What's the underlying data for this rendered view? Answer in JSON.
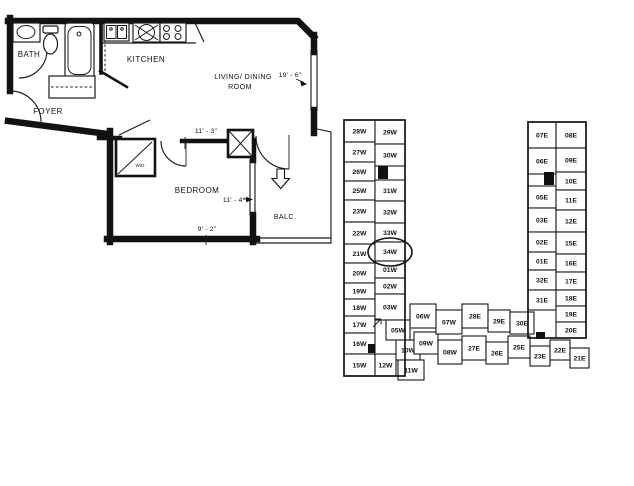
{
  "floor_plan": {
    "room_labels": {
      "bath": "BATH",
      "kitchen": "KITCHEN",
      "foyer": "FOYER",
      "living_line1": "LIVING/ DINING",
      "living_line2": "ROOM",
      "bedroom": "BEDROOM",
      "balcony": "BALC.",
      "washer_dryer": "W/D"
    },
    "dimensions": {
      "living_depth": "19' - 6\"",
      "bedroom_width_top": "11' - 3\"",
      "bedroom_depth": "11' - 4\"",
      "bedroom_width_bottom": "9' - 2\""
    }
  },
  "key_plan": {
    "highlighted_unit": "34W",
    "units": [
      {
        "label": "28W",
        "x": 2,
        "y": 12,
        "w": 31,
        "h": 22
      },
      {
        "label": "27W",
        "x": 2,
        "y": 34,
        "w": 31,
        "h": 20
      },
      {
        "label": "26W",
        "x": 2,
        "y": 54,
        "w": 31,
        "h": 19
      },
      {
        "label": "25W",
        "x": 2,
        "y": 73,
        "w": 31,
        "h": 19
      },
      {
        "label": "23W",
        "x": 2,
        "y": 92,
        "w": 31,
        "h": 22
      },
      {
        "label": "22W",
        "x": 2,
        "y": 114,
        "w": 31,
        "h": 22
      },
      {
        "label": "21W",
        "x": 2,
        "y": 136,
        "w": 31,
        "h": 19
      },
      {
        "label": "20W",
        "x": 2,
        "y": 155,
        "w": 31,
        "h": 20
      },
      {
        "label": "19W",
        "x": 2,
        "y": 175,
        "w": 31,
        "h": 16
      },
      {
        "label": "18W",
        "x": 2,
        "y": 191,
        "w": 31,
        "h": 17
      },
      {
        "label": "17W",
        "x": 2,
        "y": 208,
        "w": 31,
        "h": 17
      },
      {
        "label": "16W",
        "x": 2,
        "y": 225,
        "w": 31,
        "h": 21
      },
      {
        "label": "15W",
        "x": 2,
        "y": 246,
        "w": 31,
        "h": 22
      },
      {
        "label": "29W",
        "x": 33,
        "y": 12,
        "w": 30,
        "h": 24
      },
      {
        "label": "30W",
        "x": 33,
        "y": 36,
        "w": 30,
        "h": 22
      },
      {
        "label": "31W",
        "x": 33,
        "y": 72,
        "w": 30,
        "h": 21
      },
      {
        "label": "32W",
        "x": 33,
        "y": 93,
        "w": 30,
        "h": 22
      },
      {
        "label": "33W",
        "x": 33,
        "y": 115,
        "w": 30,
        "h": 19
      },
      {
        "label": "34W",
        "x": 33,
        "y": 134,
        "w": 30,
        "h": 19
      },
      {
        "label": "01W",
        "x": 33,
        "y": 153,
        "w": 30,
        "h": 17
      },
      {
        "label": "02W",
        "x": 33,
        "y": 170,
        "w": 30,
        "h": 16
      },
      {
        "label": "03W",
        "x": 33,
        "y": 186,
        "w": 30,
        "h": 26
      },
      {
        "label": "05W",
        "x": 44,
        "y": 212,
        "w": 24,
        "h": 20
      },
      {
        "label": "10W",
        "x": 54,
        "y": 232,
        "w": 24,
        "h": 20
      },
      {
        "label": "12W",
        "x": 33,
        "y": 246,
        "w": 21,
        "h": 22
      },
      {
        "label": "11W",
        "x": 56,
        "y": 252,
        "w": 26,
        "h": 20
      },
      {
        "label": "06W",
        "x": 68,
        "y": 196,
        "w": 26,
        "h": 24
      },
      {
        "label": "09W",
        "x": 72,
        "y": 224,
        "w": 24,
        "h": 22
      },
      {
        "label": "07W",
        "x": 94,
        "y": 202,
        "w": 26,
        "h": 24
      },
      {
        "label": "08W",
        "x": 96,
        "y": 232,
        "w": 24,
        "h": 24
      },
      {
        "label": "28E",
        "x": 120,
        "y": 196,
        "w": 26,
        "h": 24
      },
      {
        "label": "27E",
        "x": 120,
        "y": 228,
        "w": 24,
        "h": 24
      },
      {
        "label": "29E",
        "x": 146,
        "y": 202,
        "w": 22,
        "h": 22
      },
      {
        "label": "26E",
        "x": 144,
        "y": 234,
        "w": 22,
        "h": 22
      },
      {
        "label": "30E",
        "x": 168,
        "y": 204,
        "w": 24,
        "h": 22
      },
      {
        "label": "25E",
        "x": 166,
        "y": 228,
        "w": 22,
        "h": 22
      },
      {
        "label": "23E",
        "x": 188,
        "y": 238,
        "w": 20,
        "h": 20
      },
      {
        "label": "22E",
        "x": 208,
        "y": 232,
        "w": 20,
        "h": 20
      },
      {
        "label": "21E",
        "x": 228,
        "y": 240,
        "w": 19,
        "h": 20
      },
      {
        "label": "07E",
        "x": 186,
        "y": 14,
        "w": 28,
        "h": 26
      },
      {
        "label": "06E",
        "x": 186,
        "y": 40,
        "w": 28,
        "h": 26
      },
      {
        "label": "05E",
        "x": 186,
        "y": 78,
        "w": 28,
        "h": 22
      },
      {
        "label": "03E",
        "x": 186,
        "y": 100,
        "w": 28,
        "h": 24
      },
      {
        "label": "02E",
        "x": 186,
        "y": 124,
        "w": 28,
        "h": 20
      },
      {
        "label": "01E",
        "x": 186,
        "y": 144,
        "w": 28,
        "h": 18
      },
      {
        "label": "32E",
        "x": 186,
        "y": 162,
        "w": 28,
        "h": 20
      },
      {
        "label": "31E",
        "x": 186,
        "y": 182,
        "w": 28,
        "h": 20
      },
      {
        "label": "08E",
        "x": 214,
        "y": 14,
        "w": 30,
        "h": 26
      },
      {
        "label": "09E",
        "x": 214,
        "y": 40,
        "w": 30,
        "h": 24
      },
      {
        "label": "10E",
        "x": 214,
        "y": 64,
        "w": 30,
        "h": 18
      },
      {
        "label": "11E",
        "x": 214,
        "y": 82,
        "w": 30,
        "h": 20
      },
      {
        "label": "12E",
        "x": 214,
        "y": 102,
        "w": 30,
        "h": 22
      },
      {
        "label": "15E",
        "x": 214,
        "y": 124,
        "w": 30,
        "h": 22
      },
      {
        "label": "16E",
        "x": 214,
        "y": 146,
        "w": 30,
        "h": 18
      },
      {
        "label": "17E",
        "x": 214,
        "y": 164,
        "w": 30,
        "h": 18
      },
      {
        "label": "18E",
        "x": 214,
        "y": 182,
        "w": 30,
        "h": 16
      },
      {
        "label": "19E",
        "x": 214,
        "y": 198,
        "w": 30,
        "h": 16
      },
      {
        "label": "20E",
        "x": 214,
        "y": 214,
        "w": 30,
        "h": 16
      }
    ]
  },
  "colors": {
    "ink": "#111111",
    "paper": "#ffffff"
  }
}
